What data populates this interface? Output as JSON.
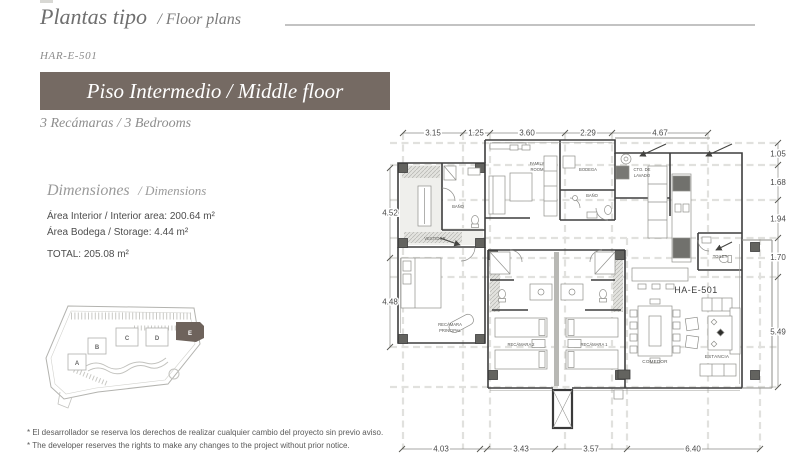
{
  "header": {
    "title_primary": "Plantas tipo",
    "title_secondary": "/ Floor plans",
    "unit_code": "HAR-E-501",
    "banner_label": "Piso Intermedio / Middle floor",
    "banner_color": "#756a63",
    "subtitle": "3 Recámaras / 3 Bedrooms"
  },
  "dimensions_panel": {
    "heading_primary": "Dimensiones",
    "heading_secondary": "/ Dimensions",
    "interior_area": "Área Interior / Interior area: 200.64 m²",
    "storage_area": "Área Bodega / Storage: 4.44 m²",
    "total": "TOTAL: 205.08 m²"
  },
  "site_plan": {
    "buildings": [
      "A",
      "B",
      "C",
      "D",
      "E"
    ],
    "highlighted_building": "E",
    "highlight_color": "#6e635c"
  },
  "floor_plan": {
    "unit_label": "HA-E-501",
    "dims_top": [
      "3.15",
      "1.25",
      "3.60",
      "2.29",
      "4.67"
    ],
    "dims_right": [
      "1.05",
      "1.68",
      "1.94",
      "1.70",
      "5.49"
    ],
    "dims_left": [
      "4.52",
      "4.48"
    ],
    "dims_bottom": [
      "4.03",
      "3.43",
      "3.57",
      "6.40"
    ],
    "rooms": {
      "vestidor": "VESTIDOR",
      "bano_principal": "BAÑO",
      "family_line1": "FAMILY",
      "family_line2": "ROOM",
      "bodega": "BODEGA",
      "bano2": "BAÑO",
      "lavado_line1": "CTO. DE",
      "lavado_line2": "LAVADO",
      "toilet": "TOILET",
      "comedor": "COMEDOR",
      "estancia": "ESTANCIA",
      "recamara_principal_line1": "RECÁMARA",
      "recamara_principal_line2": "PRINCIPAL",
      "recamara2": "RECÁMARA 2",
      "recamara1": "RECÁMARA 1"
    }
  },
  "disclaimer": {
    "line_es": "* El desarrollador se reserva los derechos de realizar cualquier cambio del proyecto sin previo aviso.",
    "line_en": "* The developer reserves the rights to make any changes to the project without prior notice."
  }
}
